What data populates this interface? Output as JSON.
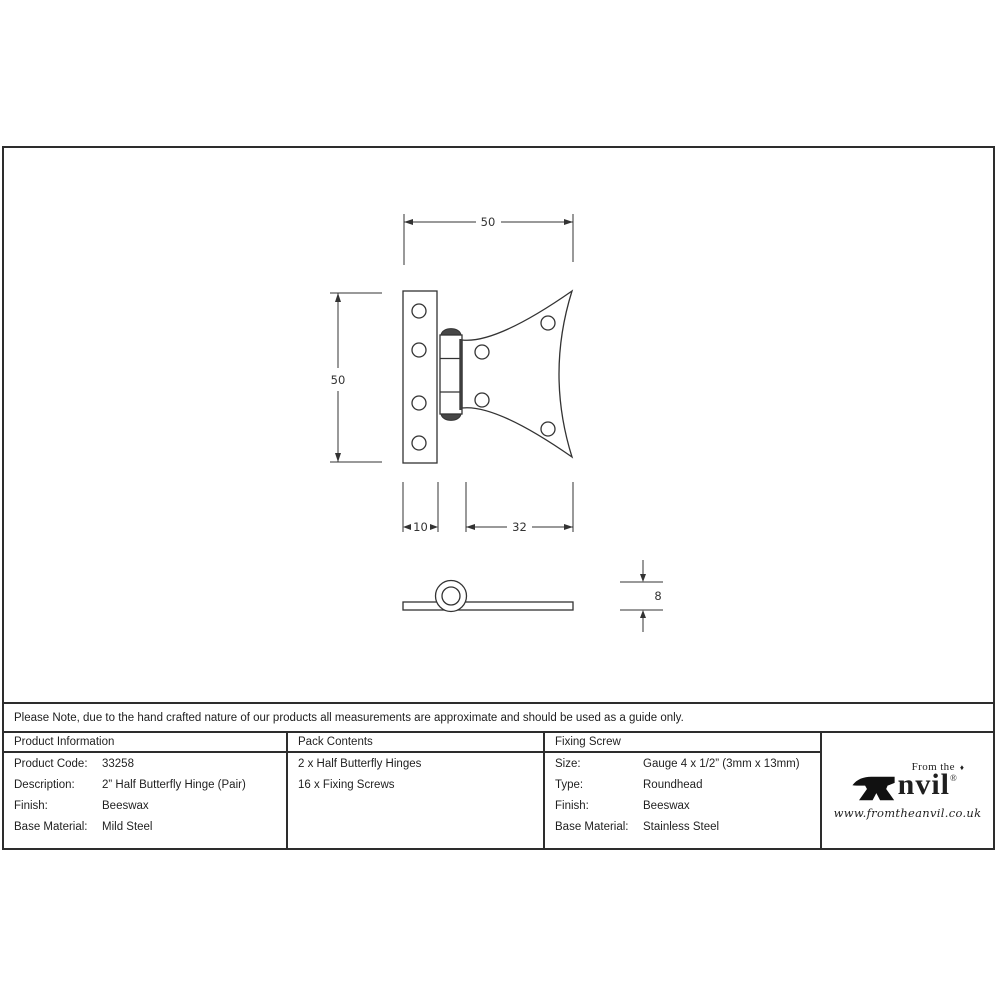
{
  "note": {
    "text": "Please Note, due to the hand crafted nature of our products all measurements are approximate and should be used as a guide only."
  },
  "drawing": {
    "front_view": {
      "width_label": "50",
      "height_label": "50",
      "leaf_width_label": "10",
      "wing_width_label": "32"
    },
    "side_view": {
      "thickness_label": "8"
    }
  },
  "table": {
    "product_information": {
      "header": "Product Information",
      "rows": [
        {
          "label": "Product Code:",
          "value": "33258"
        },
        {
          "label": "Description:",
          "value": "2” Half Butterfly Hinge (Pair)"
        },
        {
          "label": "Finish:",
          "value": "Beeswax"
        },
        {
          "label": "Base Material:",
          "value": "Mild Steel"
        }
      ]
    },
    "pack_contents": {
      "header": "Pack Contents",
      "lines": [
        "2 x Half Butterfly Hinges",
        "16 x Fixing Screws"
      ]
    },
    "fixing_screw": {
      "header": "Fixing Screw",
      "rows": [
        {
          "label": "Size:",
          "value": "Gauge 4 x 1/2” (3mm x 13mm)"
        },
        {
          "label": "Type:",
          "value": "Roundhead"
        },
        {
          "label": "Finish:",
          "value": "Beeswax"
        },
        {
          "label": "Base Material:",
          "value": "Stainless Steel"
        }
      ]
    }
  },
  "logo": {
    "tagline": "From the",
    "diamond": "♦",
    "name_rest": "nvil",
    "registered": "®",
    "url": "www.fromtheanvil.co.uk"
  }
}
